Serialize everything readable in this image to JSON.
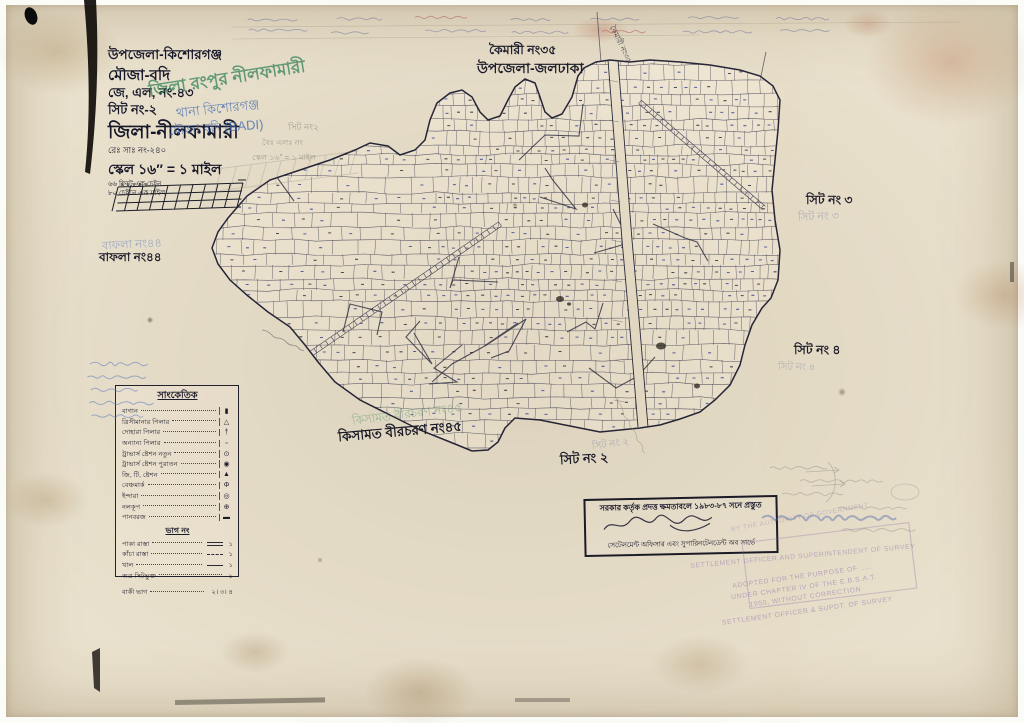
{
  "document": {
    "title_block": {
      "upazila": "উপজেলা-কিশোরগঞ্জ",
      "mouza": "মৌজা-বদি",
      "jl_no": "জে, এল, নং-৪৩",
      "sheet_no": "সিট নং-২",
      "district": "জিলা-নীলফামারী",
      "reg_no": "রেঃ সাঃ নং-২৪০",
      "scale": "স্কেল ১৬″ = ১ মাইল",
      "scale_note_1": "৬৬ ফিটে এক চেইন",
      "scale_note_2": "৮০ চেইনে এক মাইল"
    },
    "handwritten_overlay": {
      "green_district": "জিলা রংপুর নীলফামারী",
      "blue_thana": "থানা কিশোরগঞ্জ",
      "blue_mouza": "মৌজা বদি (BADI)",
      "pencil_sheet": "সিট নং২",
      "pencil_jl": "বৈঃ এলঃ নং",
      "pencil_scale": "স্কেল ১৬″ = ১ মাইল"
    },
    "neighbors": {
      "north_label_1": "কৈমারী নং৩৫",
      "north_label_2": "উপজেলা-জলঢাকা",
      "north_diagonal": "কৈমারী নং৩৫",
      "east_sheet_3": "সিট নং ৩",
      "east_sheet_3_faint": "সিট নং ৩",
      "east_sheet_4": "সিট নং ৪",
      "east_sheet_4_faint": "সিট নং ৪",
      "west_label": "বাফলা নং৪৪",
      "west_label_faint": "বাফলা নং৪৪",
      "south_label": "কিসামত বীরচরণ নং৪৫",
      "south_label_faint": "কিসামত বীরচরণ নং৪৫",
      "south_sheet_2": "সিট নং ২",
      "south_sheet_2_faint": "সিট নং ২"
    },
    "legend": {
      "title": "সাংকেতিক",
      "items": [
        {
          "label": "বাগান",
          "symbol": "▮"
        },
        {
          "label": "ত্রিসীমানার পিলার",
          "symbol": "△"
        },
        {
          "label": "দোহারা পিলার",
          "symbol": "†"
        },
        {
          "label": "অন্যান্য পিলার",
          "symbol": "▫"
        },
        {
          "label": "ট্রাভার্স ষ্টেশন নতুন",
          "symbol": "⊙"
        },
        {
          "label": "ট্রাভার্স ষ্টেশন পুরাতন",
          "symbol": "◉"
        },
        {
          "label": "জি, টি, ষ্টেশন",
          "symbol": "▲"
        },
        {
          "label": "বেঞ্চমার্ক",
          "symbol": "Φ"
        },
        {
          "label": "ইন্দারা",
          "symbol": "◎"
        },
        {
          "label": "নলকূপ",
          "symbol": "⊕"
        },
        {
          "label": "পানবরজ",
          "symbol": "▬"
        }
      ],
      "section_title": "ভাগ নং",
      "road_items": [
        {
          "label": "পাকা রাস্তা",
          "value": "১"
        },
        {
          "label": "কাঁচা রাস্তা",
          "value": "১"
        },
        {
          "label": "খাল",
          "value": "১"
        },
        {
          "label": "অত্র সিটভুক্ত",
          "value": "১"
        },
        {
          "label": "বাকী ভাগ",
          "value": "২। ৩। ৪"
        }
      ]
    },
    "stamp_box": {
      "line1": "সরকার কর্তৃক প্রদত্ত ক্ষমতাবলে ১৯৮৩-৮৭ সনে প্রস্তুত",
      "line2": "সেটেলমেন্ট অফিসার এবং সুপারিনটেনডেন্ট অব সার্ভে"
    },
    "faint_stamps": {
      "authority": "BY THE AUTHORITY OF GOVERNMENT",
      "officer_top": "SETTLEMENT OFFICER AND SUPERINTENDENT OF SURVEY",
      "adopted_1": "ADOPTED FOR THE PURPOSE OF .....",
      "adopted_2": "UNDER CHAPTER IV OF THE E.B.S.A.T.",
      "adopted_3": "1950, WITHOUT CORRECTION",
      "adopted_4": "SETTLEMENT OFFICER & SUPDT. OF SURVEY"
    }
  }
}
